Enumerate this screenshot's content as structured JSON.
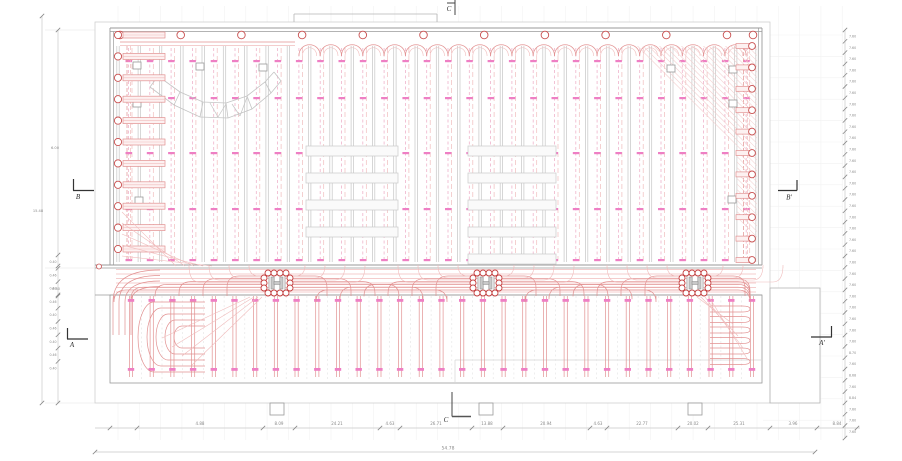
{
  "drawing": {
    "kind": "radiant-floor-heating-plan",
    "canvas": {
      "width": 902,
      "height": 461,
      "background": "#ffffff"
    }
  },
  "colors": {
    "wall": "#9a9a9a",
    "outline": "#c9c9c9",
    "joist": "#c6c6c6",
    "pipe": "#e29191",
    "pipe_light": "#f0bcbc",
    "pipe_dash": "#efb3cb",
    "marker": "#ee7fc4",
    "circle": "#c95050",
    "hatch": "#f3cfcf",
    "bar_fill": "#fdf1f1",
    "grid": "#f2f2f2",
    "dim_line": "#c9c9c9",
    "dim_text": "#8a8a8a",
    "section": "#2a2a2a",
    "square": "#9a9a9a",
    "column_fill": "#c9c9c9"
  },
  "plan": {
    "hall": {
      "x1": 110,
      "y1": 28,
      "x2": 762,
      "y2": 268
    },
    "outer": {
      "x1": 95,
      "y1": 22,
      "x2": 770,
      "y2": 403
    },
    "raised_top": {
      "x1": 294,
      "y1": 14,
      "x2": 437,
      "y2": 22
    },
    "corridor": {
      "y1": 268,
      "y2": 295
    },
    "lower_zone": {
      "x1": 110,
      "y1": 295,
      "x2": 762,
      "y2": 383
    },
    "annex": {
      "x1": 770,
      "y1": 288,
      "x2": 820,
      "y2": 403
    },
    "joists": {
      "start": 118,
      "spacing": 21.3,
      "count": 31,
      "y1": 46,
      "y2": 262
    },
    "hall_marker_rows": [
      60,
      97,
      152,
      208,
      259
    ],
    "lower_marker_rows": [
      299,
      368
    ],
    "manifold_x": [
      277,
      486,
      695
    ],
    "manifold_y": 283,
    "top_circles": {
      "start": 120,
      "spacing": 60.7,
      "count": 11,
      "y": 35
    },
    "left_circles": {
      "x": 118,
      "start": 35,
      "spacing": 21.4,
      "count": 11
    },
    "right_circles": {
      "x": 752,
      "start": 46,
      "spacing": 21.4,
      "count": 11
    },
    "rack_groups": [
      {
        "x": 306,
        "w": 92,
        "rows": [
          146,
          173,
          200,
          227
        ]
      },
      {
        "x": 468,
        "w": 88,
        "rows": [
          146,
          173,
          200,
          227,
          254
        ]
      }
    ],
    "footings_x": [
      270,
      479,
      688
    ]
  },
  "section_markers": [
    {
      "id": "B",
      "label": "B"
    },
    {
      "id": "B-prime",
      "label": "B'"
    },
    {
      "id": "A",
      "label": "A"
    },
    {
      "id": "A-prime",
      "label": "A'"
    },
    {
      "id": "C-top",
      "label": "C"
    },
    {
      "id": "C-bottom",
      "label": "C"
    }
  ],
  "dimensions": {
    "bottom": {
      "y": 428,
      "ticks": [
        110,
        137,
        263,
        295,
        380,
        400,
        472,
        503,
        590,
        607,
        678,
        708,
        770,
        817,
        857
      ],
      "labels": [
        {
          "x": 200,
          "t": "4.88"
        },
        {
          "x": 279,
          "t": "8.09"
        },
        {
          "x": 337,
          "t": "24.21"
        },
        {
          "x": 390,
          "t": "4.63"
        },
        {
          "x": 436,
          "t": "26.71"
        },
        {
          "x": 487,
          "t": "13.88"
        },
        {
          "x": 546,
          "t": "20.94"
        },
        {
          "x": 598,
          "t": "4.63"
        },
        {
          "x": 642,
          "t": "22.77"
        },
        {
          "x": 693,
          "t": "20.02"
        },
        {
          "x": 739,
          "t": "25.31"
        },
        {
          "x": 793,
          "t": "3.96"
        },
        {
          "x": 837,
          "t": "8.84"
        }
      ]
    },
    "overall_bottom": {
      "y": 452,
      "x1": 95,
      "x2": 815,
      "label": "54.78",
      "label_x": 448
    },
    "left": {
      "line1_x": 42,
      "line2_x": 58,
      "labels": [
        {
          "x": 55,
          "y": 149,
          "t": "6.00"
        },
        {
          "x": 38,
          "y": 212,
          "t": "15.48"
        },
        {
          "x": 56,
          "y": 290,
          "t": "0.60"
        }
      ],
      "sub_ticks": {
        "x": 58,
        "start_y": 255,
        "step": 13.3,
        "labels": [
          "0.40",
          "0.46",
          "0.40",
          "0.46",
          "0.40",
          "0.46",
          "0.40",
          "0.46",
          "0.40"
        ]
      }
    },
    "right": {
      "x": 845,
      "y1": 30,
      "y2": 438,
      "step": 11.3,
      "labels": [
        "7.60",
        "7.60",
        "7.60",
        "7.60",
        "7.60",
        "7.60",
        "7.60",
        "7.60",
        "7.60",
        "7.60",
        "7.60",
        "7.60",
        "7.60",
        "7.60",
        "7.60",
        "7.60",
        "7.60",
        "7.60",
        "7.60",
        "7.60",
        "7.60",
        "7.60",
        "7.60",
        "7.60",
        "7.60",
        "7.60",
        "7.60",
        "7.60",
        "8.70",
        "7.60",
        "8.68",
        "7.60",
        "8.84",
        "7.60",
        "7.60",
        "7.60"
      ]
    }
  }
}
